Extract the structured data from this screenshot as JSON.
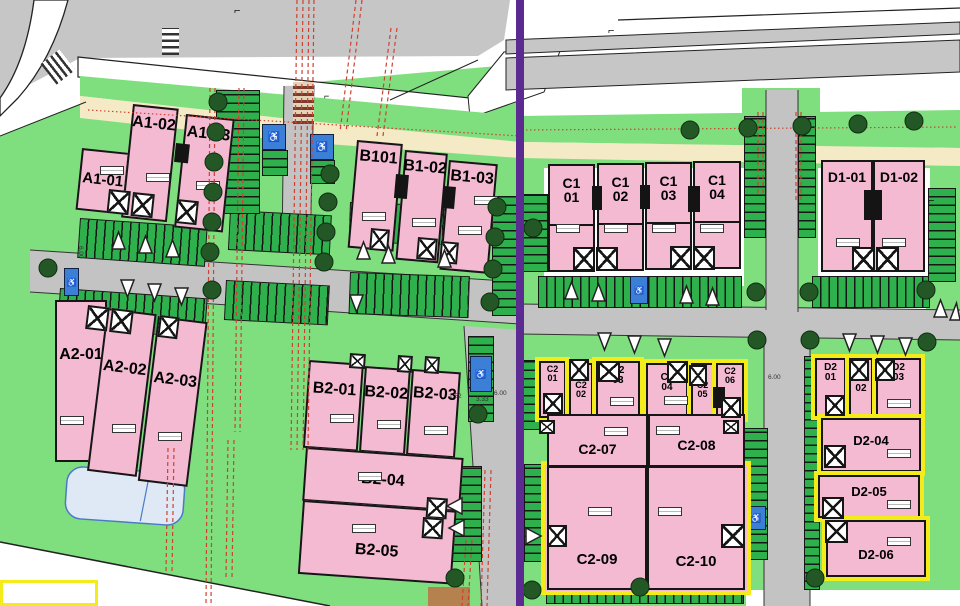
{
  "title": "Residential development site plan",
  "colors": {
    "grass": "#7fdf7f",
    "parking_stall": "#2eb04c",
    "building_pink": "#f3bad2",
    "highlight_yellow": "#f4ec1a",
    "phase_boundary_purple": "#5c2b91",
    "road_gray": "#c3c3c3",
    "sidewalk_beige": "#f4ebc6",
    "water_blue": "#dfe9f6",
    "grid_dashed_red": "#d0402f"
  },
  "plots": {
    "a1_01": "A1-01",
    "a1_02": "A1-02",
    "a1_03": "A1-03",
    "b1_01": "B101",
    "b1_02": "B1-02",
    "b1_03": "B1-03",
    "c1_01": "C1\n01",
    "c1_02": "C1\n02",
    "c1_03": "C1\n03",
    "c1_04": "C1\n04",
    "d1_01": "D1-01",
    "d1_02": "D1-02",
    "a2_01": "A2-01",
    "a2_02": "A2-02",
    "a2_03": "A2-03",
    "b2_01": "B2-01",
    "b2_02": "B2-02",
    "b2_03": "B2-03",
    "b2_04": "B2-04",
    "b2_05": "B2-05",
    "c2_01": "C2\n01",
    "c2_02": "C2\n02",
    "c2_03": "C2\n03",
    "c2_04": "C2\n04",
    "c2_05": "C2\n05",
    "c2_06": "C2\n06",
    "c2_07": "C2-07",
    "c2_08": "C2-08",
    "c2_09": "C2-09",
    "c2_10": "C2-10",
    "d2_01": "D2\n01",
    "d2_02": "D2\n02",
    "d2_03": "D2\n03",
    "d2_04": "D2-04",
    "d2_05": "D2-05",
    "d2_06": "D2-06"
  },
  "dimensions": {
    "d1": "6.00",
    "d2": "6.00",
    "d3": "6.00",
    "d4": "1.52",
    "d5": "3.33"
  },
  "icons": {
    "wheelchair": "♿",
    "corner_marker": "⌐"
  }
}
